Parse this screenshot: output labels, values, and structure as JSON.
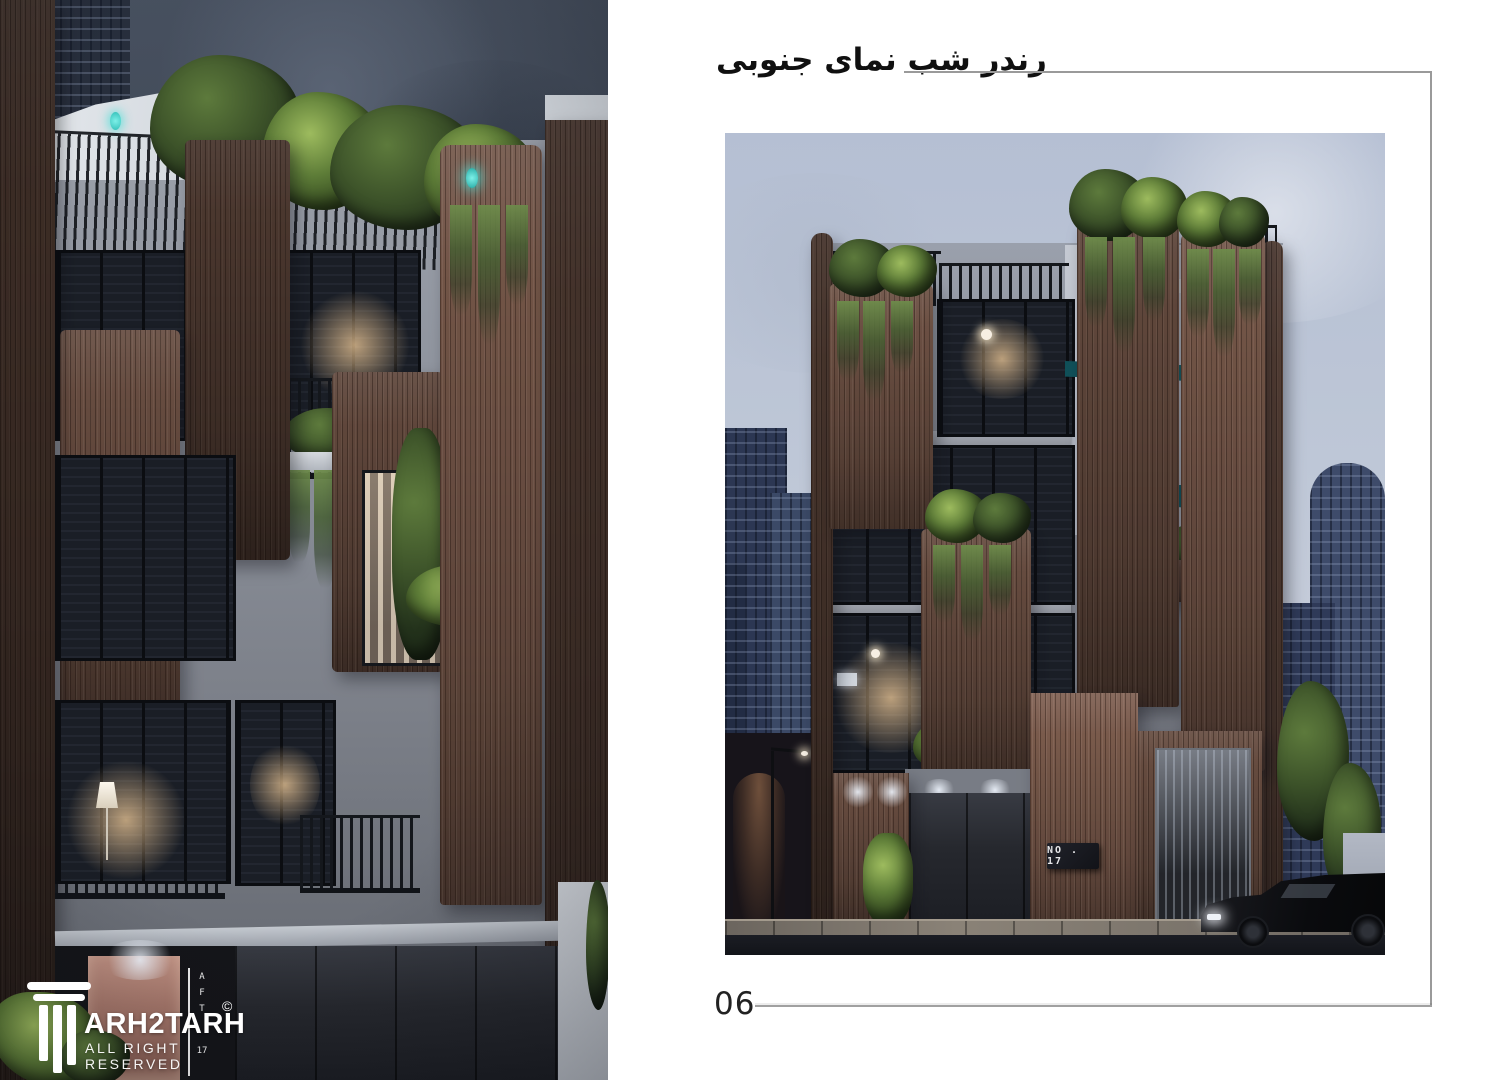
{
  "header": {
    "title": "رندر شب نمای جنوبی"
  },
  "footer": {
    "page_number": "06"
  },
  "brand": {
    "name": "ARH2TARH",
    "copyright": "©",
    "tagline": "ALL RIGHT RESERVED",
    "icon": "classical-column-icon"
  },
  "right_render": {
    "plaque_text": "NO . 17"
  },
  "left_render": {
    "door_sign": {
      "letters": [
        "A",
        "F",
        "T"
      ],
      "number": "17"
    }
  },
  "colors": {
    "page_bg": "#ffffff",
    "rule_gray": "#9a9a9a",
    "title_text": "#101010",
    "day_sky": "#bfc8d8",
    "night_sky": "#434c5c",
    "wood": "#77584a",
    "plaster": "#8b8f99",
    "teal_awning": "#166a73",
    "cyan_light": "#4fe0d8",
    "greenery": "#3c5229",
    "window_dark": "#14171f",
    "warm_light": "#d8a87a",
    "road": "#16181e"
  }
}
